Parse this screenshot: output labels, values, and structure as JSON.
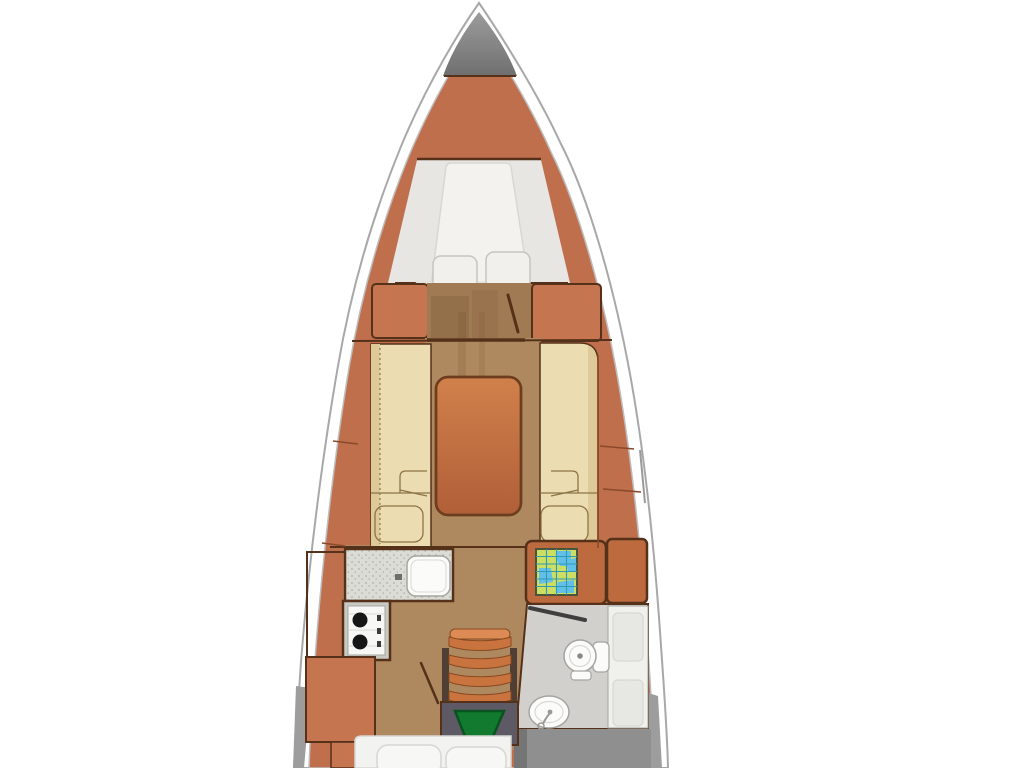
{
  "illustration": {
    "kind": "yacht-interior-floor-plan",
    "orientation": "bow-up"
  },
  "colors": {
    "bg": "#ffffff",
    "hull_band": "#ffffff",
    "hull_stroke": "#a8a8a8",
    "inner_stroke": "#bdbdbd",
    "deck_orange": "#c06f4c",
    "wardrobe_orange": "#c57550",
    "deck_seam": "#8a4a2a",
    "outline_dark": "#55311a",
    "locker_top": "#9c9c9c",
    "locker_bottom": "#6f6f6f",
    "platform": "#e7e6e2",
    "mattress": "#f3f2ef",
    "mattress_fold": "#dfdeda",
    "pillow": "#f1f0ed",
    "pillow_stroke": "#c6c5c1",
    "wood": "#ae895f",
    "wood_corridor": "#a07a52",
    "wood_patch": "#6b4f33",
    "cream": "#ebdcb2",
    "cream_dark": "#ddca98",
    "detail_stroke": "#8d7447",
    "table_top": "#d0814b",
    "table_bottom": "#b05f38",
    "table_stroke": "#6e3c1e",
    "counter": "#dcdcd6",
    "counter_dot": "#b0b0a4",
    "sink": "#fbfbf9",
    "fixture_stroke": "#a5a5a0",
    "soft_stroke": "#d8d8d3",
    "stove_body": "#f7f7f5",
    "stove_frame": "#c9c9c3",
    "burner": "#161616",
    "chart_desk": "#bd6a3e",
    "map_bg": "#ccdf63",
    "map_blue": "#62c0e8",
    "map_grid": "#2f9ab5",
    "map_border": "#49543c",
    "head_floor": "#d2d0cc",
    "head_counter": "#f0f0ed",
    "head_inset": "#e7e7e3",
    "door_gray": "#3f3f3f",
    "steps_rail": "#4e3e34",
    "tread": "#c9743f",
    "tread_hi": "#dd8b55",
    "tread_stroke": "#8a4a22",
    "hatch_frame": "#5d5a66",
    "hatch_green": "#117a2e",
    "hatch_green_stroke": "#0a5220",
    "cushion": "#f2f2f0",
    "cushion_stroke": "#d6d6d3",
    "cockpit": "#8f8f8f",
    "cockpit_dark": "#757575",
    "shadow_wedge": "#9d9d9d"
  }
}
